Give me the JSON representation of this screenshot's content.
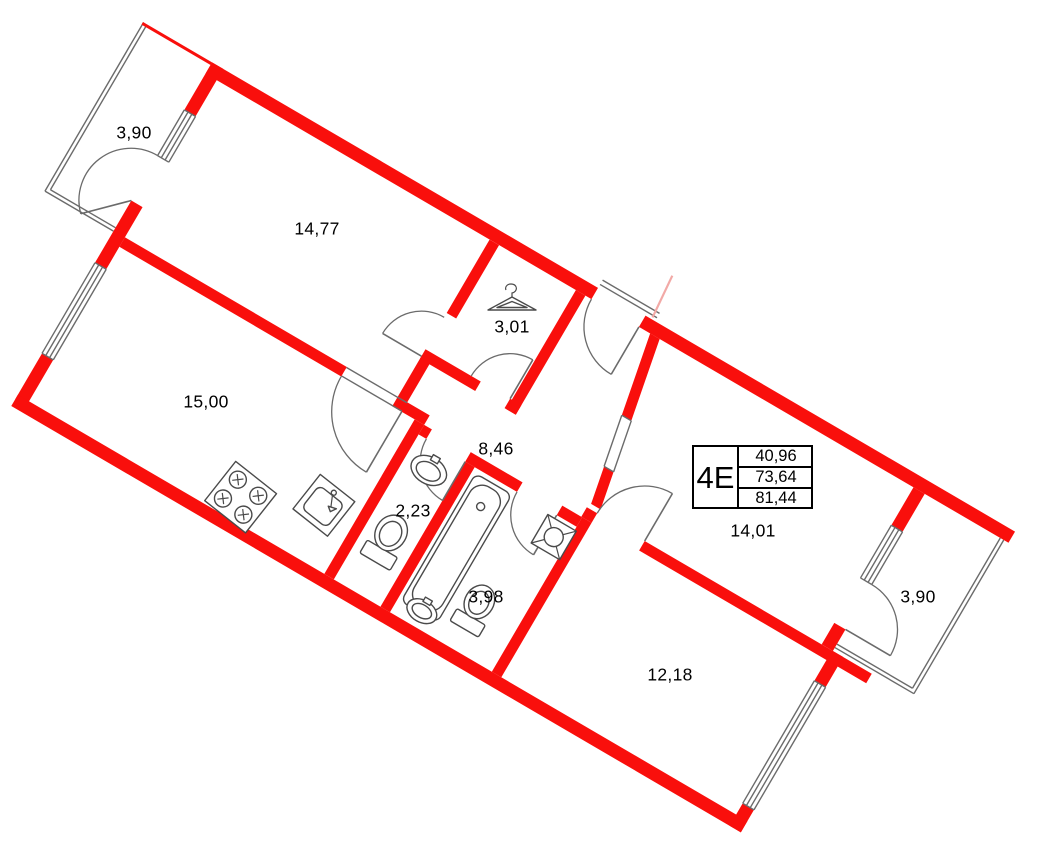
{
  "plan_title": "apartment-floor-plan",
  "colors": {
    "wall": "#f90f0c",
    "outline": "#6b6b6b",
    "fixture": "#4a4a4a",
    "text": "#000000",
    "neighbor_wall": "#f2a9a6"
  },
  "info_box": {
    "unit": "4E",
    "rows": [
      "40,96",
      "73,64",
      "81,44"
    ],
    "x": 692,
    "y": 445,
    "w": 121,
    "h": 64
  },
  "room_labels": [
    {
      "name": "balcony-left",
      "area": "3,90",
      "x": 134,
      "y": 133
    },
    {
      "name": "room-14-77",
      "area": "14,77",
      "x": 317,
      "y": 229
    },
    {
      "name": "room-15-00",
      "area": "15,00",
      "x": 206,
      "y": 402
    },
    {
      "name": "closet-3-01",
      "area": "3,01",
      "x": 512,
      "y": 327
    },
    {
      "name": "hall-8-46",
      "area": "8,46",
      "x": 496,
      "y": 449
    },
    {
      "name": "wc-2-23",
      "area": "2,23",
      "x": 413,
      "y": 511
    },
    {
      "name": "bathroom-3-98",
      "area": "3,98",
      "x": 486,
      "y": 597
    },
    {
      "name": "room-14-01",
      "area": "14,01",
      "x": 753,
      "y": 531
    },
    {
      "name": "room-12-18",
      "area": "12,18",
      "x": 670,
      "y": 675
    },
    {
      "name": "balcony-right",
      "area": "3,90",
      "x": 918,
      "y": 597
    }
  ],
  "icons": [
    "hanger-icon",
    "stove-icon",
    "kitchen-sink-icon",
    "washbasin-icon",
    "toilet-icon",
    "bathtub-icon",
    "washing-machine-icon",
    "window-icon",
    "door-arc-icon"
  ]
}
